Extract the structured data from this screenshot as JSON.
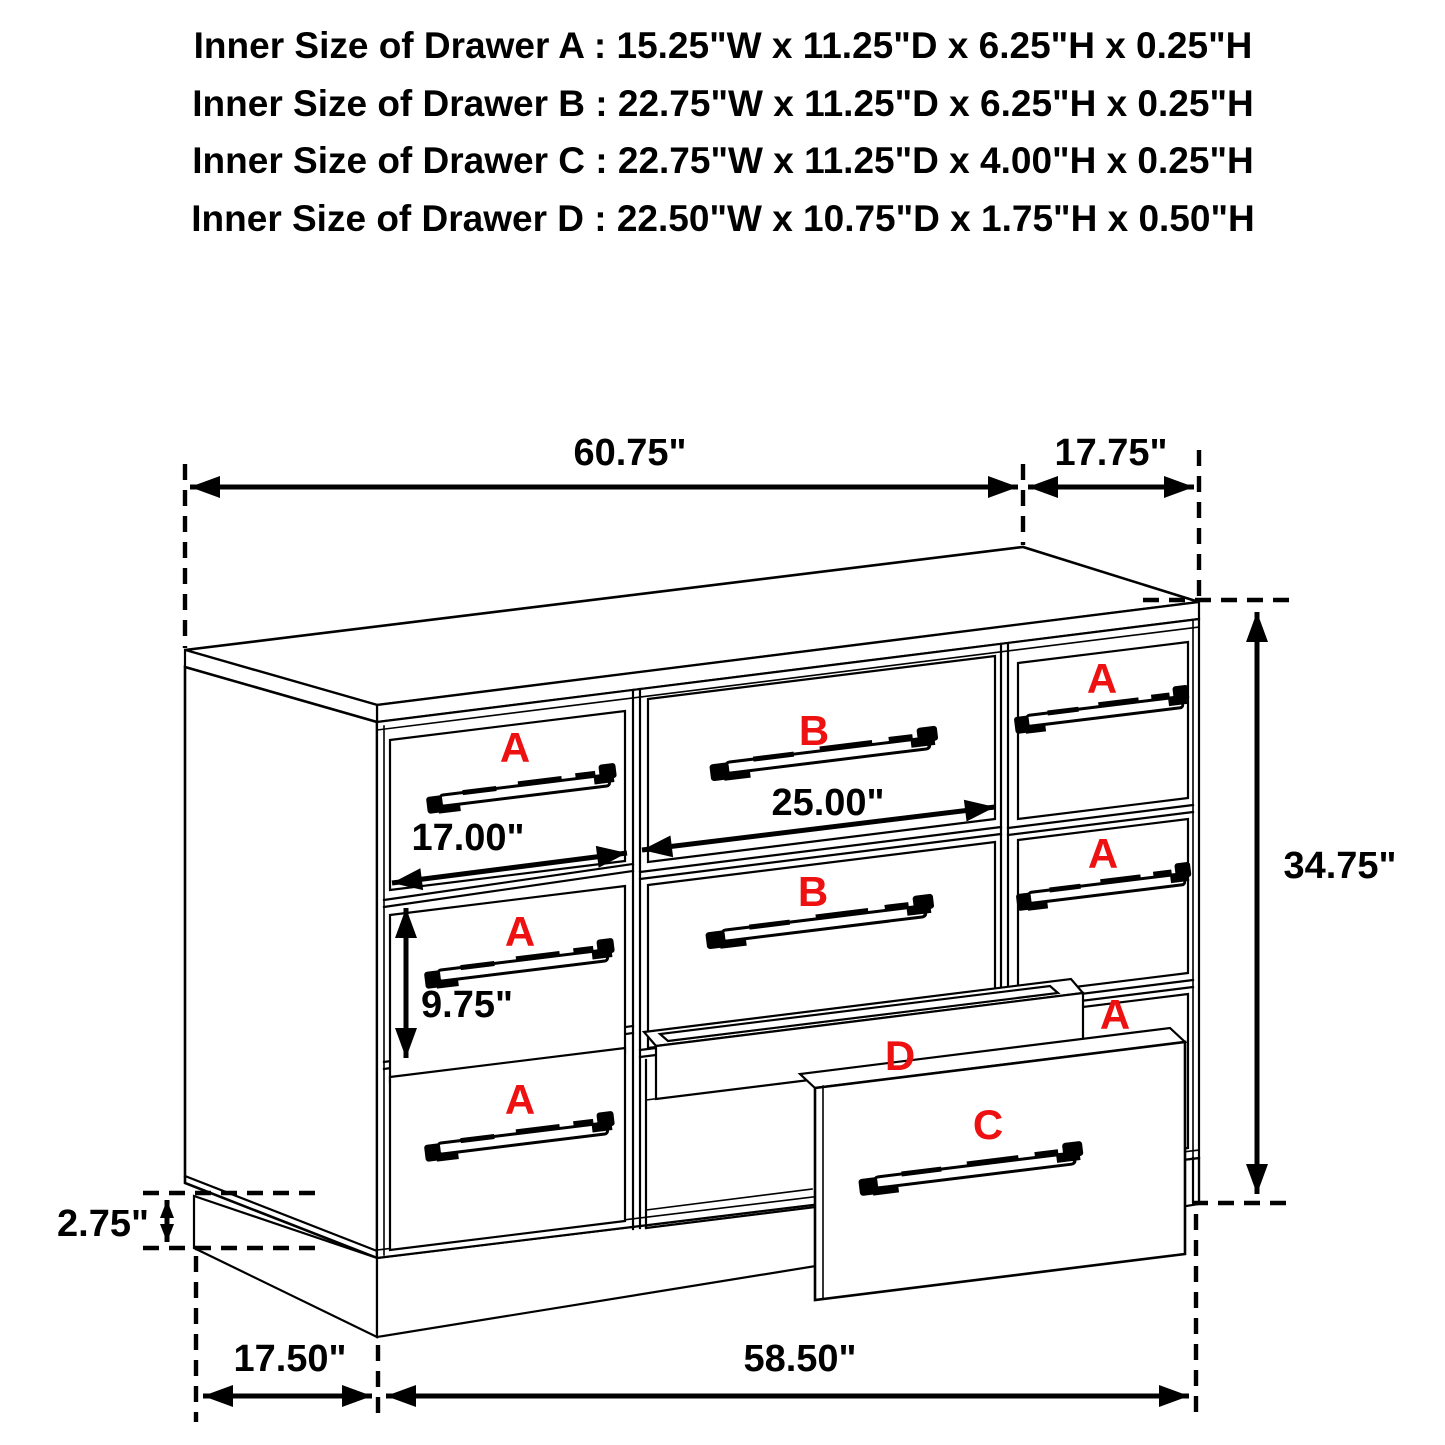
{
  "title_block": {
    "lines": [
      "Inner Size of Drawer A : 15.25\"W x 11.25\"D x 6.25\"H x 0.25\"H",
      "Inner Size of Drawer B : 22.75\"W x 11.25\"D x 6.25\"H x 0.25\"H",
      "Inner Size of Drawer C : 22.75\"W x 11.25\"D x 4.00\"H x 0.25\"H",
      "Inner Size of Drawer  D : 22.50\"W x 10.75\"D x 1.75\"H x 0.50\"H"
    ]
  },
  "dimensions": {
    "top_width": "60.75\"",
    "top_depth": "17.75\"",
    "overall_height": "34.75\"",
    "left_drawer_width": "17.00\"",
    "middle_drawer_width": "25.00\"",
    "side_drawer_height": "9.75\"",
    "base_height": "2.75\"",
    "base_depth": "17.50\"",
    "base_width": "58.50\""
  },
  "drawer_letters": {
    "a": "A",
    "b": "B",
    "c": "C",
    "d": "D"
  },
  "colors": {
    "label_red": "#ee1111",
    "line_black": "#000000",
    "background": "#ffffff"
  }
}
